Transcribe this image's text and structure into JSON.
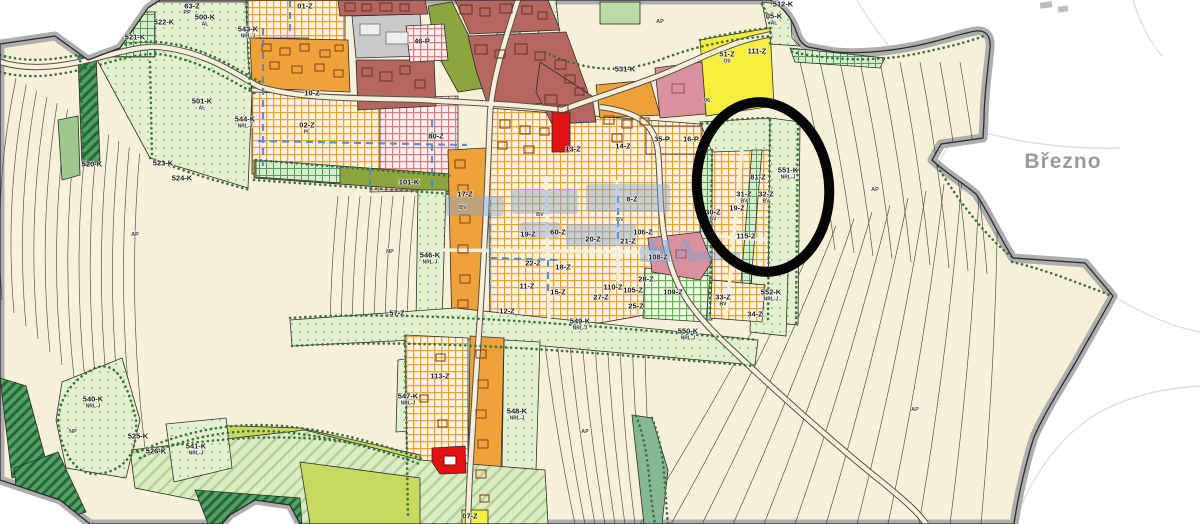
{
  "map": {
    "title": "Územní plán – zoning map with highlighted area",
    "place_label": "Březno",
    "annotation": {
      "shape": "ellipse",
      "purpose": "highlight-circle",
      "color": "#000000"
    },
    "watermark": {
      "visible_letters": "HA",
      "color": "#7aa3d6"
    },
    "colors": {
      "plan_fill": "#f8f1da",
      "boundary_band": "#adadad",
      "outside": "#ffffff",
      "orange_solid": "#efa23a",
      "brick_red": "#b5675f",
      "bright_red": "#e01212",
      "green_light_dots": "#e3f1cf",
      "green_dark_hatch": "#1f6b3a",
      "olive": "#8ba63c",
      "yellow_green_fields": "#c7d95f",
      "yellow": "#f6ee3f",
      "rose": "#d9919e",
      "gray_blocks": "#c9c9c9",
      "utility_blue": "#4d86c8",
      "place_label_gray": "#9a9a9a"
    },
    "zone_labels": [
      {
        "x": 205,
        "y": 17,
        "t": "500-K",
        "sub": "AL"
      },
      {
        "x": 248,
        "y": 29,
        "t": "543-K",
        "sub": "NRL-J"
      },
      {
        "x": 135,
        "y": 37,
        "t": "521-K"
      },
      {
        "x": 164,
        "y": 22,
        "t": "522-K"
      },
      {
        "x": 192,
        "y": 6,
        "t": "63-Z"
      },
      {
        "x": 305,
        "y": 6,
        "t": "01-Z"
      },
      {
        "x": 202,
        "y": 101,
        "t": "501-K",
        "sub": "AL"
      },
      {
        "x": 245,
        "y": 119,
        "t": "544-K",
        "sub": "NRL-J"
      },
      {
        "x": 92,
        "y": 164,
        "t": "520-K"
      },
      {
        "x": 163,
        "y": 163,
        "t": "523-K"
      },
      {
        "x": 182,
        "y": 178,
        "t": "524-K"
      },
      {
        "x": 307,
        "y": 125,
        "t": "02-Z",
        "sub": "PL"
      },
      {
        "x": 312,
        "y": 93,
        "t": "10-Z"
      },
      {
        "x": 422,
        "y": 41,
        "t": "46-P"
      },
      {
        "x": 436,
        "y": 136,
        "t": "80-Z"
      },
      {
        "x": 625,
        "y": 69,
        "t": "531-K"
      },
      {
        "x": 774,
        "y": 16,
        "t": "05-K",
        "sub": "AL"
      },
      {
        "x": 783,
        "y": 4,
        "t": "512-K"
      },
      {
        "x": 727,
        "y": 54,
        "t": "51-Z",
        "sub": "OS"
      },
      {
        "x": 757,
        "y": 51,
        "t": "111-Z"
      },
      {
        "x": 662,
        "y": 139,
        "t": "35-P"
      },
      {
        "x": 691,
        "y": 139,
        "t": "16-P"
      },
      {
        "x": 788,
        "y": 170,
        "t": "551-K",
        "sub": "NRL-J"
      },
      {
        "x": 758,
        "y": 177,
        "t": "81-Z"
      },
      {
        "x": 744,
        "y": 194,
        "t": "31-Z",
        "sub": "BV"
      },
      {
        "x": 766,
        "y": 194,
        "t": "32-Z",
        "sub": "BV"
      },
      {
        "x": 713,
        "y": 212,
        "t": "30-Z",
        "sub": "BV"
      },
      {
        "x": 737,
        "y": 208,
        "t": "19-Z"
      },
      {
        "x": 746,
        "y": 236,
        "t": "115-Z"
      },
      {
        "x": 723,
        "y": 297,
        "t": "33-Z",
        "sub": "BV"
      },
      {
        "x": 755,
        "y": 314,
        "t": "34-Z"
      },
      {
        "x": 771,
        "y": 292,
        "t": "552-K",
        "sub": "NRL-J"
      },
      {
        "x": 673,
        "y": 292,
        "t": "109-Z"
      },
      {
        "x": 658,
        "y": 257,
        "t": "108-Z"
      },
      {
        "x": 465,
        "y": 194,
        "t": "17-Z"
      },
      {
        "x": 528,
        "y": 234,
        "t": "19-Z"
      },
      {
        "x": 558,
        "y": 232,
        "t": "60-Z"
      },
      {
        "x": 593,
        "y": 239,
        "t": "20-Z"
      },
      {
        "x": 632,
        "y": 199,
        "t": "8-Z"
      },
      {
        "x": 628,
        "y": 241,
        "t": "21-Z"
      },
      {
        "x": 643,
        "y": 232,
        "t": "106-Z"
      },
      {
        "x": 533,
        "y": 263,
        "t": "22-Z"
      },
      {
        "x": 563,
        "y": 267,
        "t": "18-Z"
      },
      {
        "x": 646,
        "y": 279,
        "t": "28-Z"
      },
      {
        "x": 527,
        "y": 286,
        "t": "11-Z"
      },
      {
        "x": 558,
        "y": 292,
        "t": "15-Z"
      },
      {
        "x": 613,
        "y": 287,
        "t": "110-Z"
      },
      {
        "x": 633,
        "y": 290,
        "t": "105-Z"
      },
      {
        "x": 601,
        "y": 297,
        "t": "27-Z"
      },
      {
        "x": 636,
        "y": 306,
        "t": "25-Z"
      },
      {
        "x": 507,
        "y": 311,
        "t": "12-Z"
      },
      {
        "x": 573,
        "y": 149,
        "t": "13-Z"
      },
      {
        "x": 623,
        "y": 146,
        "t": "14-Z"
      },
      {
        "x": 430,
        "y": 255,
        "t": "546-K",
        "sub": "NRL-J"
      },
      {
        "x": 409,
        "y": 182,
        "t": "101-K"
      },
      {
        "x": 397,
        "y": 313,
        "t": "57-Z"
      },
      {
        "x": 408,
        "y": 396,
        "t": "547-K",
        "sub": "NRL-J"
      },
      {
        "x": 440,
        "y": 376,
        "t": "113-Z"
      },
      {
        "x": 517,
        "y": 411,
        "t": "548-K",
        "sub": "NRL-J"
      },
      {
        "x": 580,
        "y": 321,
        "t": "549-K",
        "sub": "NRL-J"
      },
      {
        "x": 688,
        "y": 331,
        "t": "550-K",
        "sub": "NRL-J"
      },
      {
        "x": 93,
        "y": 399,
        "t": "540-K",
        "sub": "NRL-J"
      },
      {
        "x": 196,
        "y": 446,
        "t": "541-K",
        "sub": "NRL-J"
      },
      {
        "x": 138,
        "y": 436,
        "t": "525-K"
      },
      {
        "x": 156,
        "y": 451,
        "t": "526-K"
      },
      {
        "x": 470,
        "y": 516,
        "t": "07-Z"
      }
    ],
    "small_labels": [
      {
        "x": 660,
        "y": 21,
        "t": "AP"
      },
      {
        "x": 875,
        "y": 189,
        "t": "AP"
      },
      {
        "x": 915,
        "y": 409,
        "t": "AP"
      },
      {
        "x": 585,
        "y": 431,
        "t": "AP"
      },
      {
        "x": 135,
        "y": 234,
        "t": "AP"
      },
      {
        "x": 73,
        "y": 431,
        "t": "NP"
      },
      {
        "x": 390,
        "y": 251,
        "t": "NP"
      },
      {
        "x": 187,
        "y": 12,
        "t": "PP"
      },
      {
        "x": 707,
        "y": 100,
        "t": "06"
      },
      {
        "x": 463,
        "y": 207,
        "t": "BV"
      },
      {
        "x": 540,
        "y": 214,
        "t": "BV"
      },
      {
        "x": 620,
        "y": 219,
        "t": "BV"
      }
    ]
  }
}
